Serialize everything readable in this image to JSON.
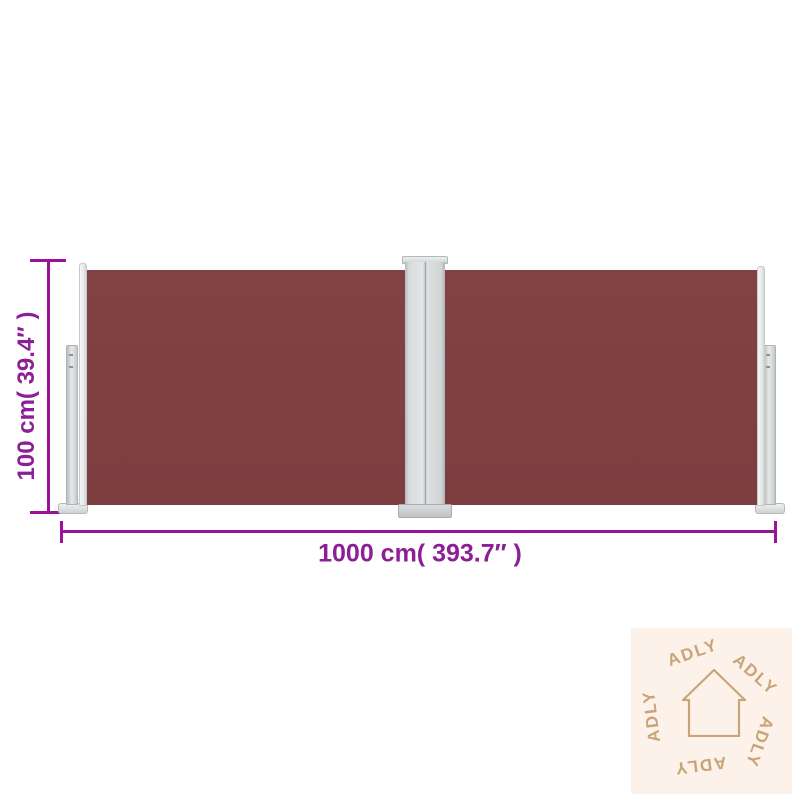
{
  "scene": {
    "type": "product-dimension-diagram",
    "background_color": "#ffffff",
    "product_name": "retractable double side awning"
  },
  "awning": {
    "fabric_color": "#7e4041",
    "frame_color": "#d8dbdc",
    "panel_count": 2
  },
  "dimensions": {
    "height": {
      "label": "100 cm( 39.4″ )"
    },
    "width": {
      "label": "1000 cm( 393.7″ )"
    },
    "line_color": "#9a119a",
    "text_color": "#8d1f96"
  },
  "watermark": {
    "brand": "ADLY",
    "background_color": "#fcf2e9",
    "accent_color": "#c9a478",
    "icon": "house-outline-icon",
    "words": [
      {
        "text": "ADLY"
      },
      {
        "text": "ADLY"
      },
      {
        "text": "ADLY"
      },
      {
        "text": "ADLY"
      },
      {
        "text": "ADLY"
      }
    ]
  }
}
